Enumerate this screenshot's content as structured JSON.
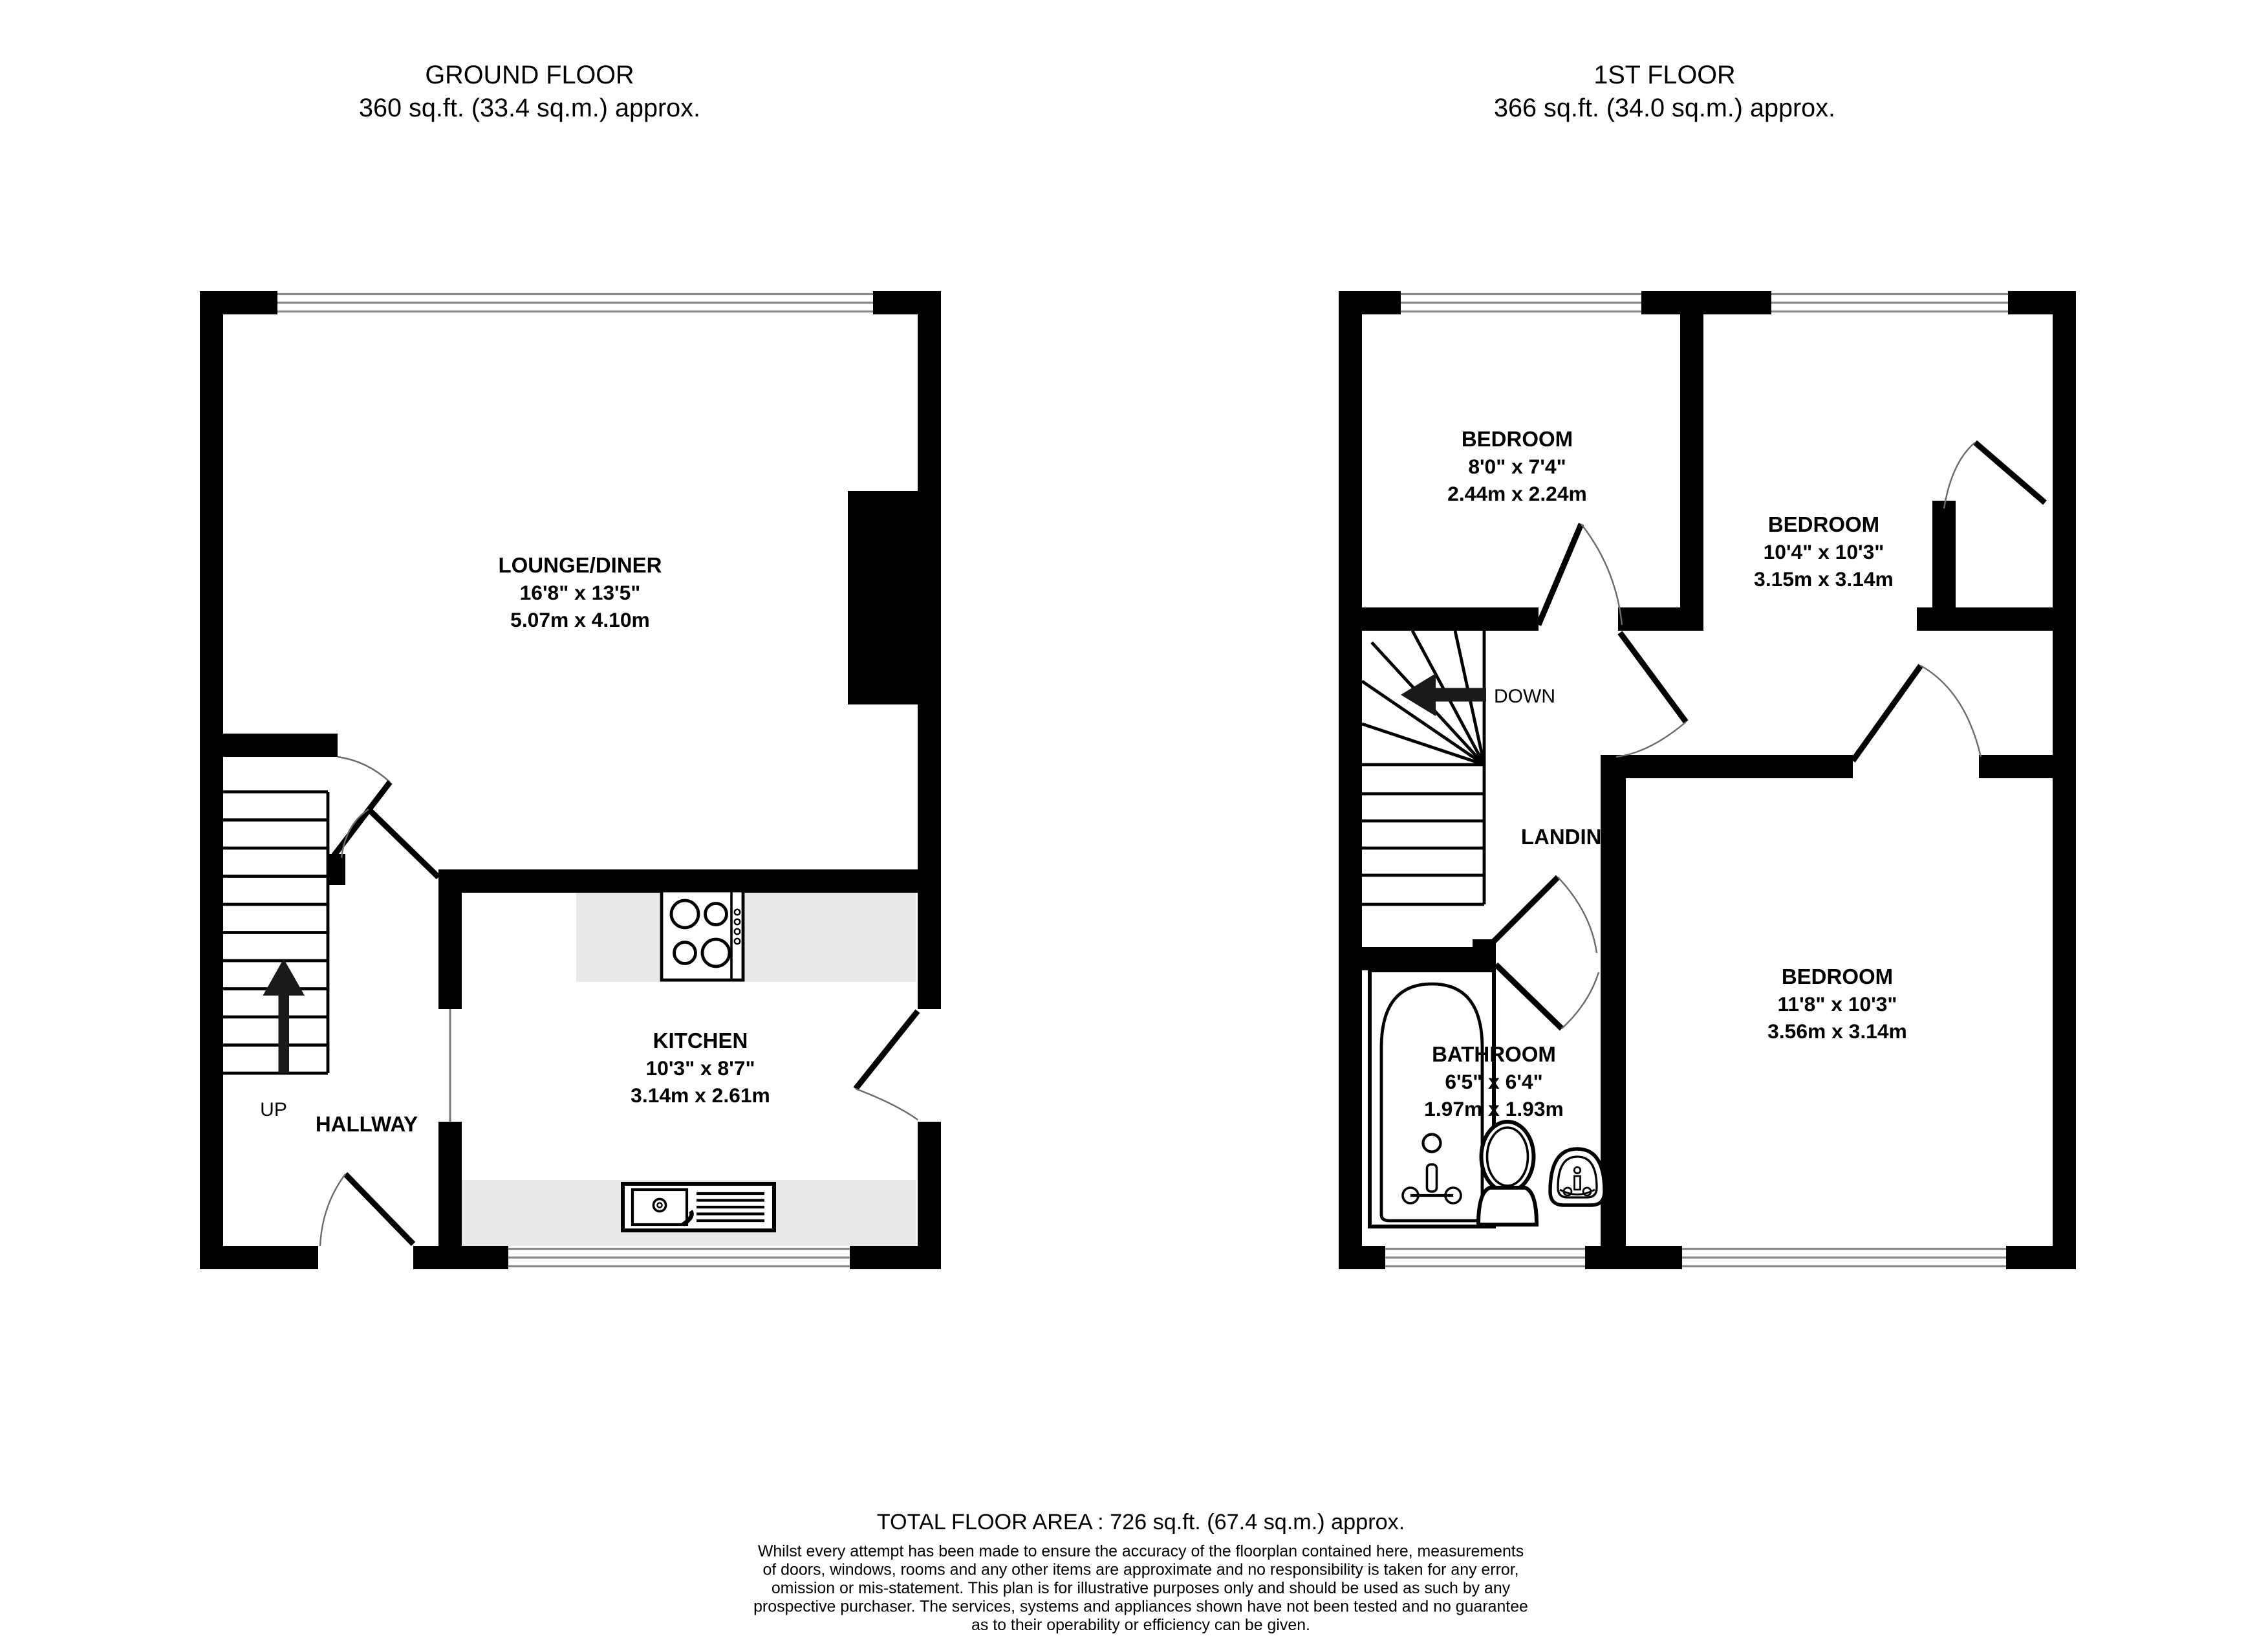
{
  "ground_floor": {
    "title": "GROUND FLOOR",
    "subtitle": "360 sq.ft. (33.4 sq.m.) approx.",
    "rooms": {
      "lounge": {
        "name": "LOUNGE/DINER",
        "imperial": "16'8\"  x 13'5\"",
        "metric": "5.07m  x 4.10m"
      },
      "kitchen": {
        "name": "KITCHEN",
        "imperial": "10'3\"  x 8'7\"",
        "metric": "3.14m  x 2.61m"
      },
      "hallway": {
        "name": "HALLWAY"
      }
    },
    "stairs_label": "UP"
  },
  "first_floor": {
    "title": "1ST FLOOR",
    "subtitle": "366 sq.ft. (34.0 sq.m.) approx.",
    "rooms": {
      "bedroom1": {
        "name": "BEDROOM",
        "imperial": "8'0\"  x 7'4\"",
        "metric": "2.44m  x 2.24m"
      },
      "bedroom2": {
        "name": "BEDROOM",
        "imperial": "10'4\"  x 10'3\"",
        "metric": "3.15m  x 3.14m"
      },
      "bedroom3": {
        "name": "BEDROOM",
        "imperial": "11'8\"  x 10'3\"",
        "metric": "3.56m  x 3.14m"
      },
      "bathroom": {
        "name": "BATHROOM",
        "imperial": "6'5\"  x 6'4\"",
        "metric": "1.97m  x 1.93m"
      },
      "landing": {
        "name": "LANDING"
      }
    },
    "stairs_label": "DOWN"
  },
  "footer": {
    "total": "TOTAL FLOOR AREA : 726 sq.ft. (67.4 sq.m.) approx.",
    "disclaimer_lines": [
      "Whilst every attempt has been made to ensure the accuracy of the floorplan contained here, measurements",
      "of doors, windows, rooms and any other items are approximate and no responsibility is taken for any error,",
      "omission or mis-statement. This plan is for illustrative purposes only and should be used as such by any",
      "prospective purchaser. The services, systems and appliances shown have not been tested and no guarantee",
      "as to their operability or efficiency can be given."
    ],
    "credit": "Made with Metropix ©2025"
  },
  "colors": {
    "wall": "#000000",
    "counter": "#e8e8e8",
    "window_line": "#8a8a8a",
    "background": "#ffffff"
  }
}
